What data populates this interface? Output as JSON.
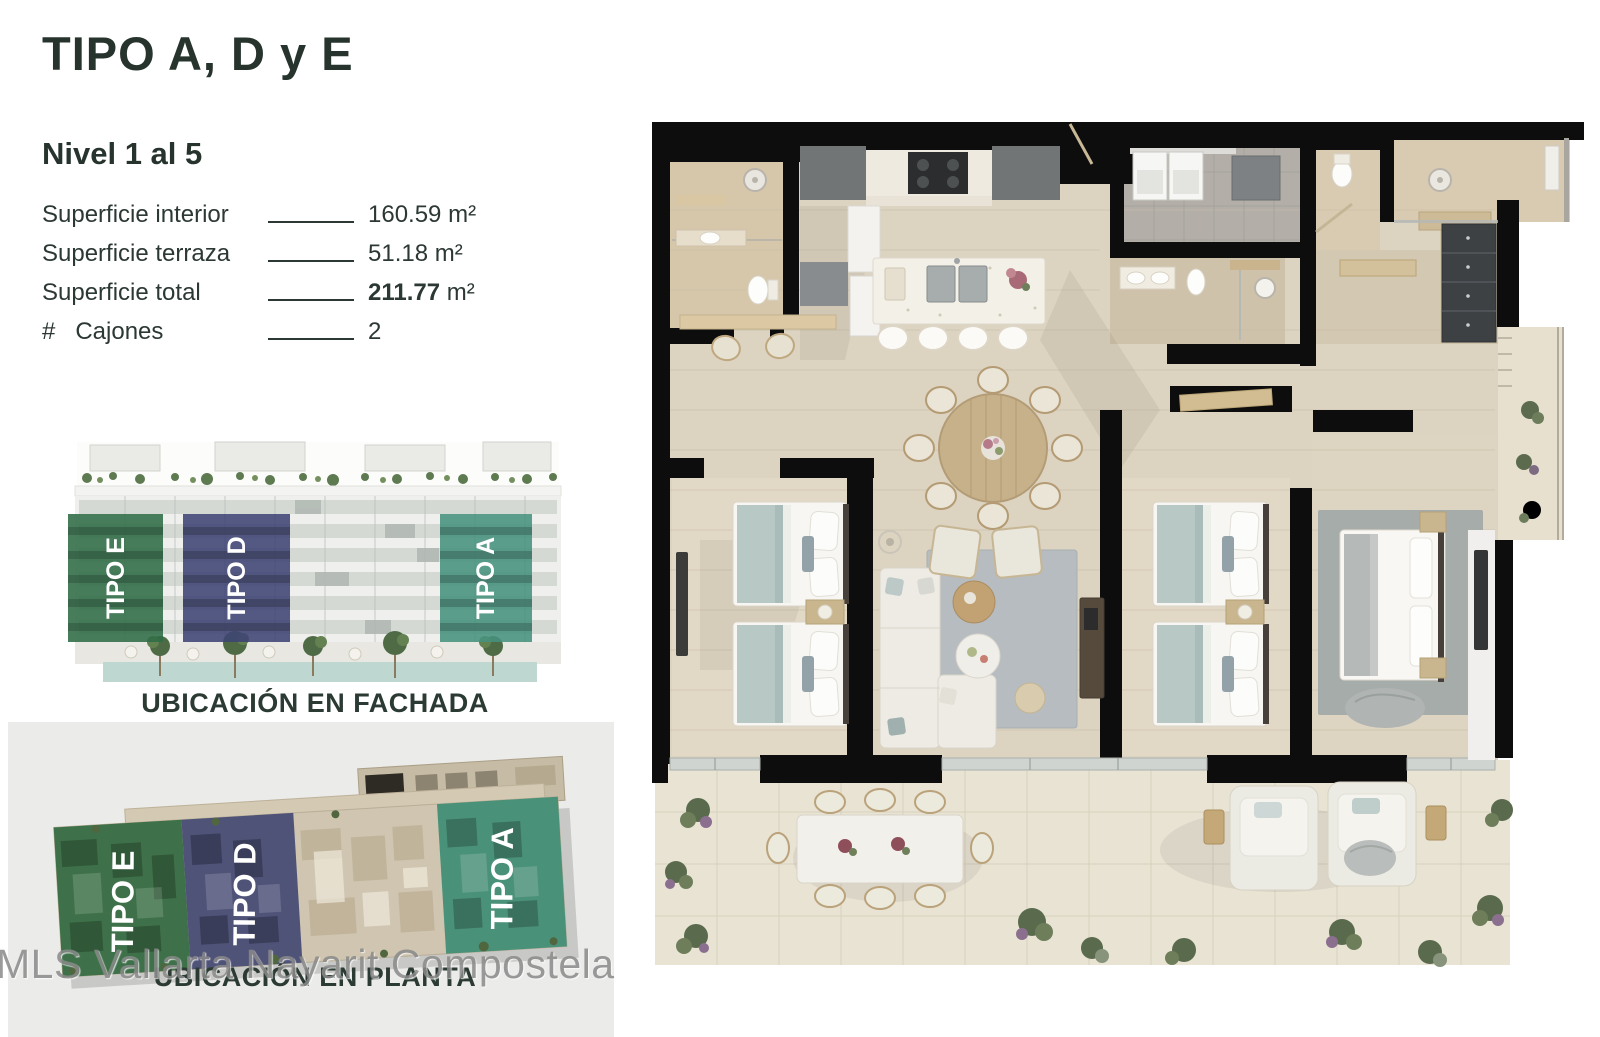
{
  "palette": {
    "heading": "#27342e",
    "body_text": "#2c3833",
    "panel_bg": "#ebebe9",
    "watermark_gray": "#8a8a8a",
    "plan_wall_black": "#0d0d0d",
    "floor_beige": "#dcd3c1",
    "terrace_beige": "#e9e3d4"
  },
  "header": {
    "title": "TIPO A, D y E"
  },
  "specs": {
    "level_title": "Nivel 1 al 5",
    "rows": [
      {
        "label": "Superficie interior",
        "value": "160.59",
        "unit": " m²"
      },
      {
        "label": "Superficie terraza",
        "value": "51.18",
        "unit": " m²"
      },
      {
        "label": "Superficie total",
        "value": "211.77",
        "unit": " m²"
      },
      {
        "label": "#   Cajones",
        "value": "2",
        "unit": ""
      }
    ]
  },
  "facade": {
    "caption": "UBICACIÓN EN FACHADA",
    "units": [
      {
        "label": "TIPO E",
        "color": "#2f6b45"
      },
      {
        "label": "TIPO D",
        "color": "#3e4373"
      },
      {
        "label": "TIPO A",
        "color": "#47917d"
      }
    ]
  },
  "siteplan": {
    "caption": "UBICACIÓN EN PLANTA",
    "units": [
      {
        "label": "TIPO E",
        "color": "#336b41"
      },
      {
        "label": "TIPO D",
        "color": "#454a73"
      },
      {
        "label": "TIPO A",
        "color": "#3f8d74"
      }
    ]
  },
  "watermark": {
    "text": "MLS Vallarta Nayarit Compostela"
  }
}
